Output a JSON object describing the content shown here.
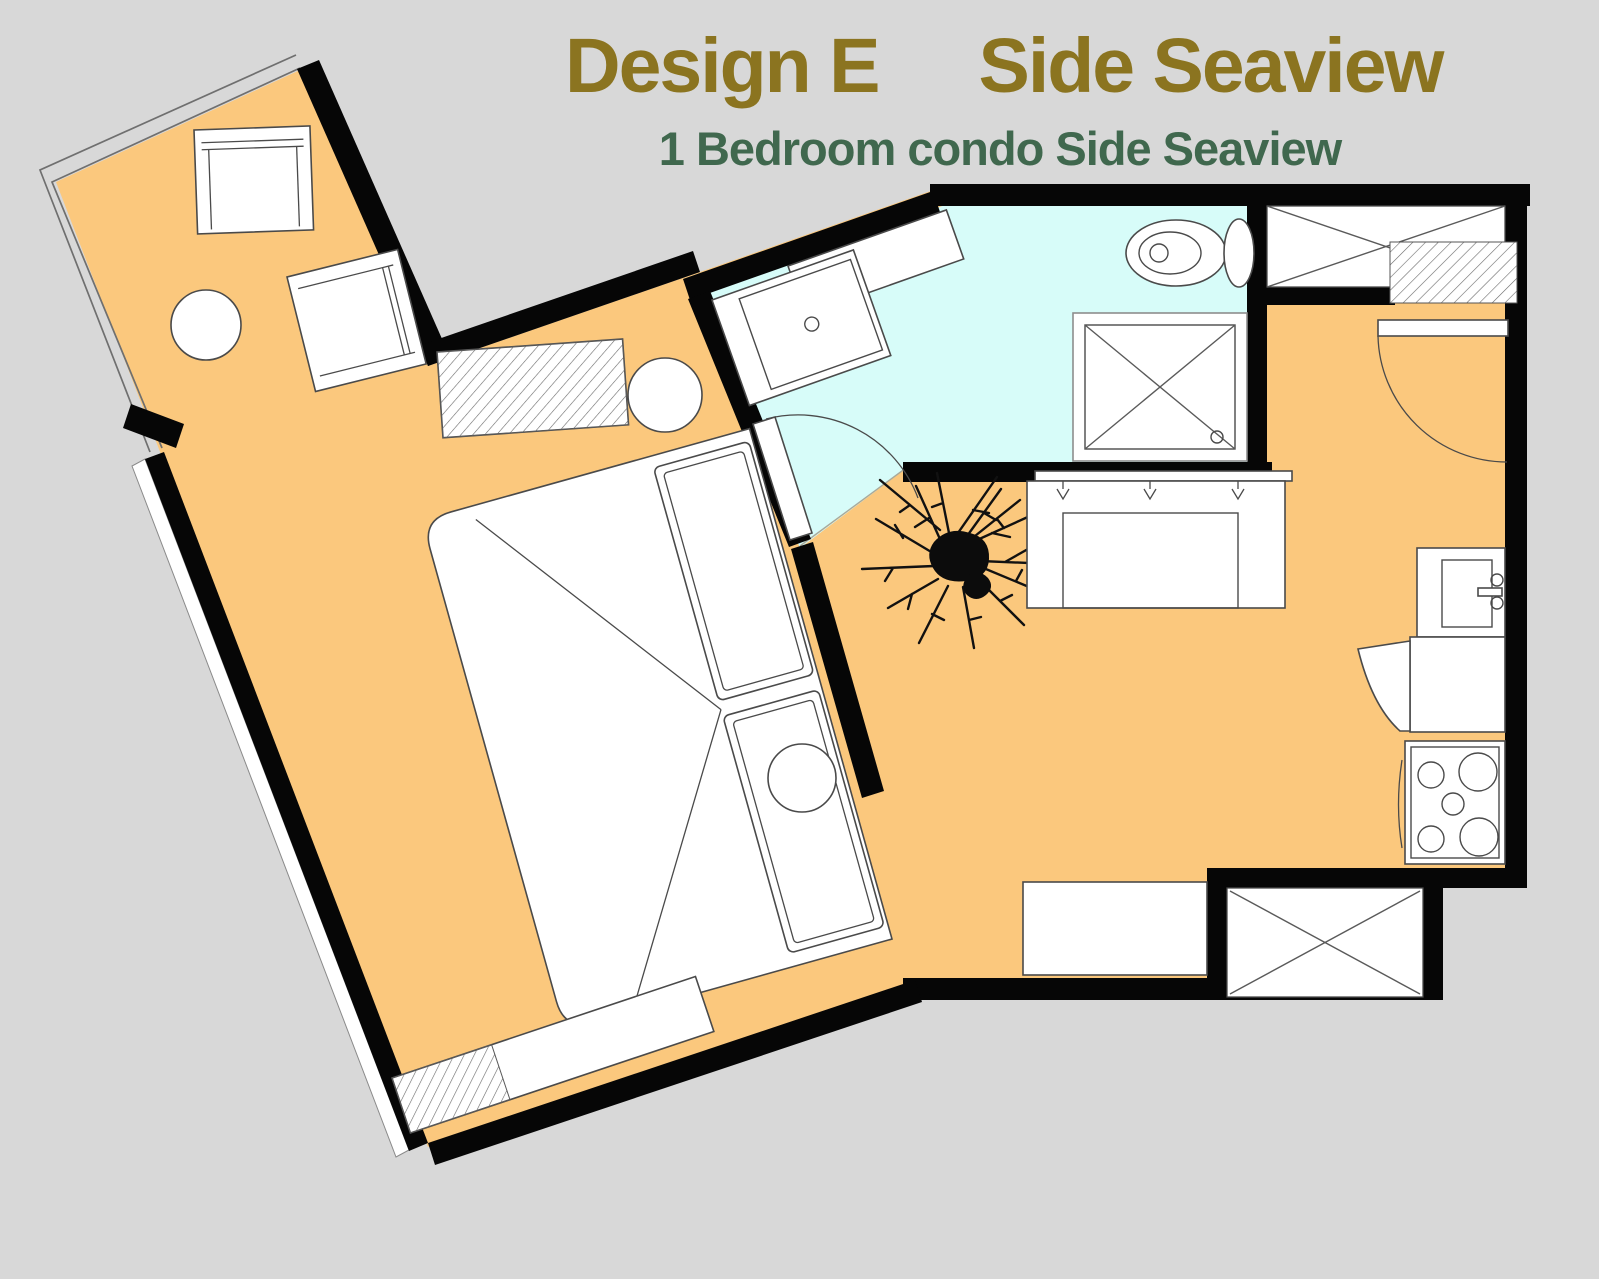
{
  "title": {
    "part1": "Design E",
    "part2": "Side Seaview"
  },
  "subtitle": "1 Bedroom condo Side Seaview",
  "colors": {
    "background": "#d8d8d8",
    "floor": "#fbc87d",
    "bathroom-floor": "#d7fcf9",
    "wall": "#060606",
    "line": "#4a4a4a",
    "hatch-line": "#6a6a6a",
    "railing": "#6f6f6f",
    "title-color": "#8b7420",
    "subtitle-color": "#40684e"
  },
  "legend": {
    "plan_type": "1 bedroom condominium floor plan",
    "rooms": [
      "balcony",
      "bedroom",
      "bathroom",
      "living-room",
      "kitchen",
      "entry-hall",
      "closet-top-right",
      "closet-bottom-right"
    ],
    "furniture": [
      "balcony-chair",
      "balcony-chair",
      "balcony-round-table",
      "wardrobe-hatch",
      "double-bed",
      "pillows",
      "nightstand",
      "nightstand",
      "low-bench",
      "bathroom-shelf",
      "vanity-sink",
      "toilet",
      "shower",
      "bathroom-door",
      "plant",
      "sofa",
      "entrance-door",
      "entry-mat",
      "kitchen-sink",
      "kitchen-counter",
      "fridge-door-swing",
      "stove",
      "side-counter"
    ]
  }
}
